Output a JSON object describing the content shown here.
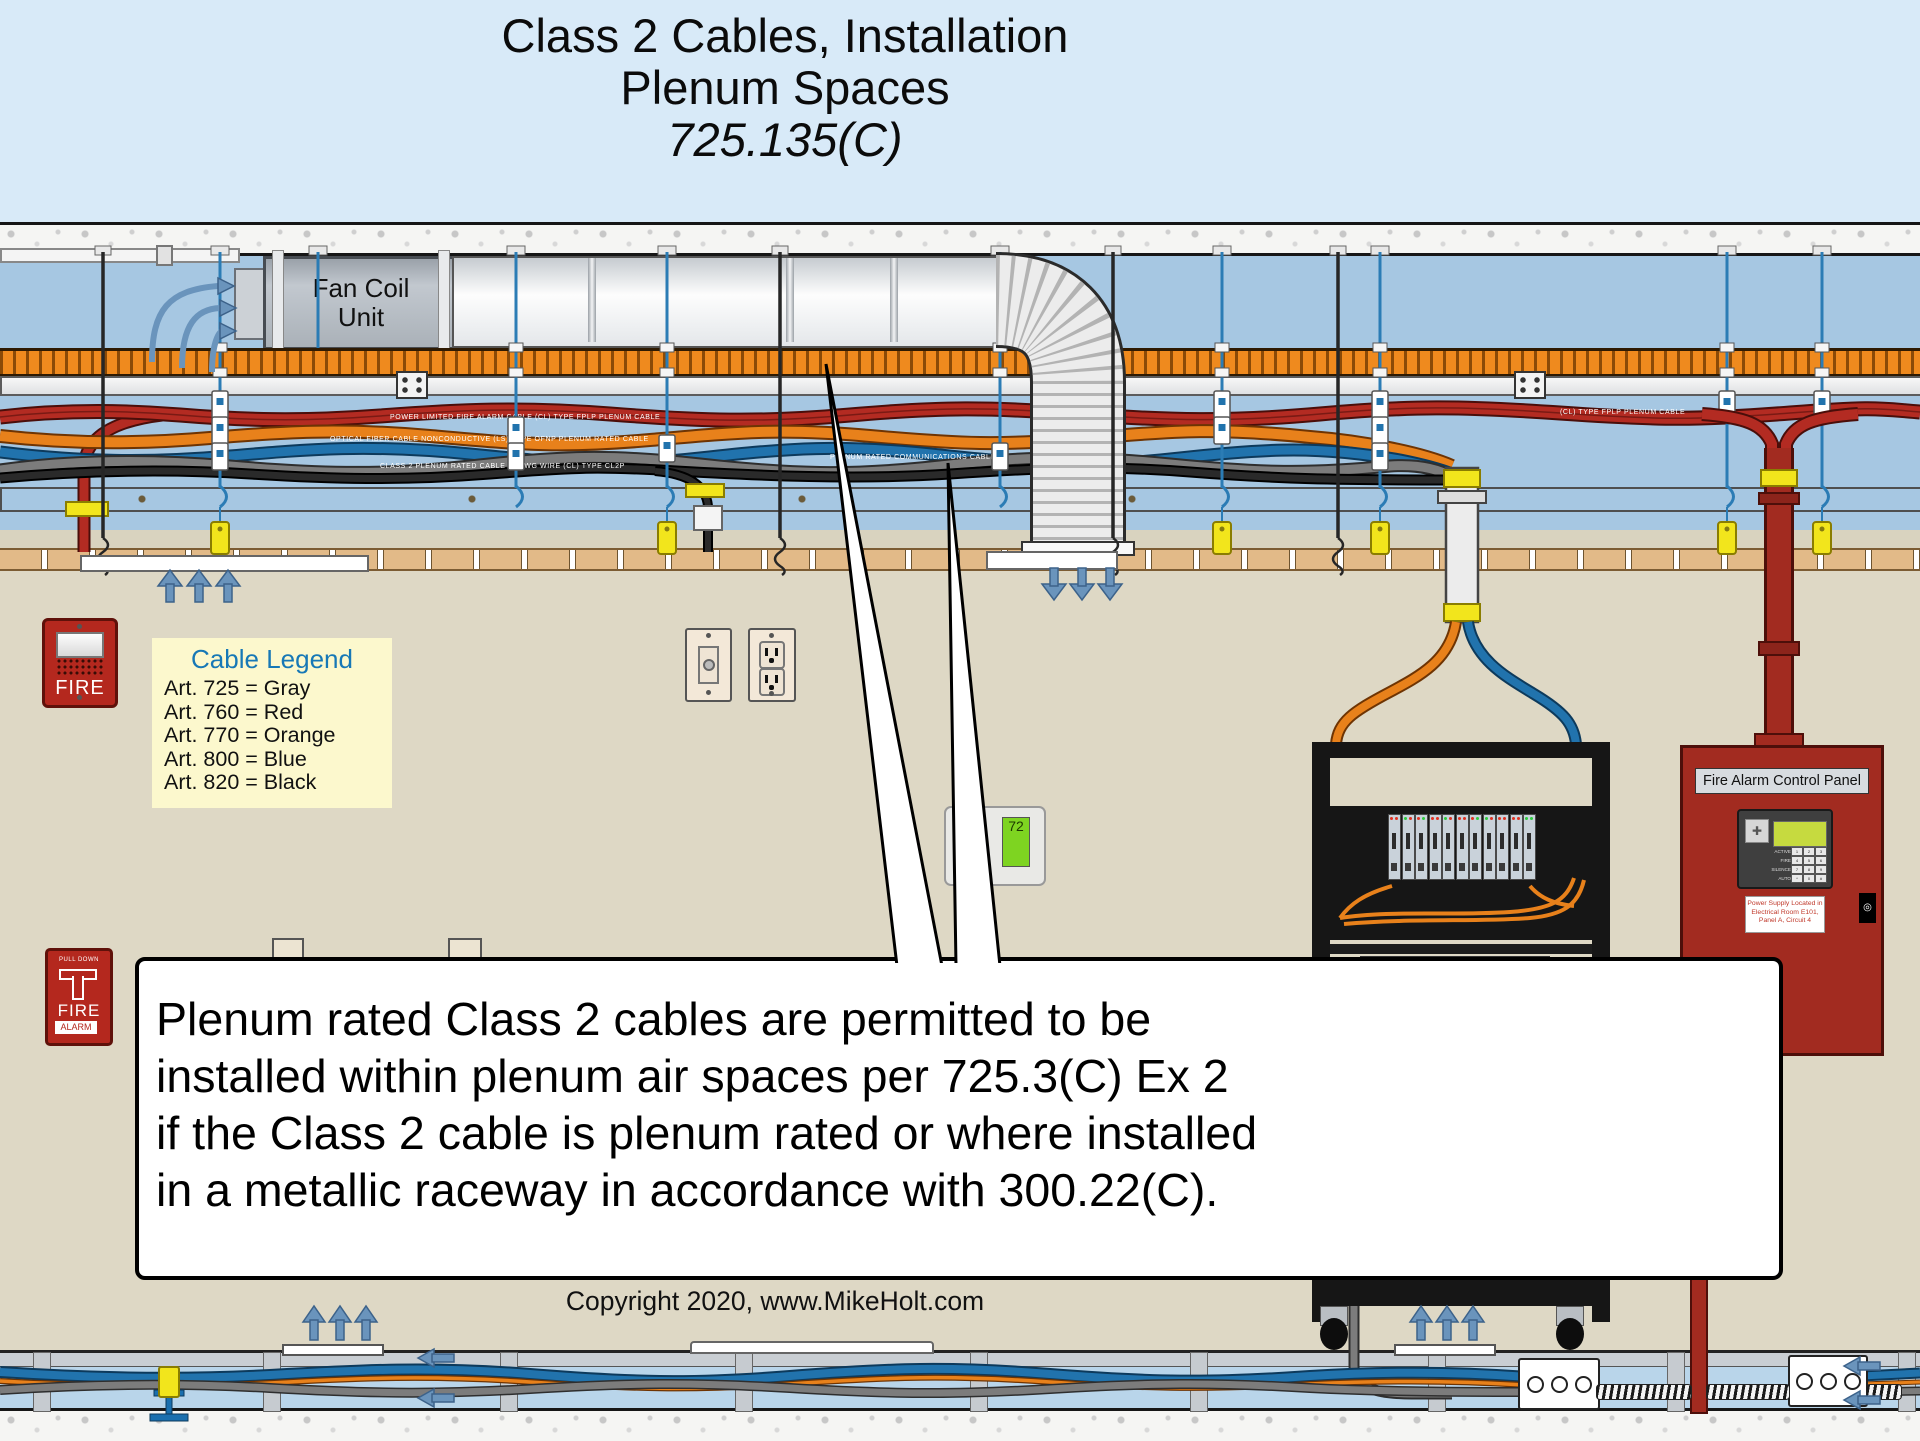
{
  "title": {
    "line1": "Class 2 Cables, Installation",
    "line2": "Plenum Spaces",
    "line3": "725.135(C)"
  },
  "legend": {
    "title": "Cable Legend",
    "items": [
      "Art. 725 = Gray",
      "Art. 760 = Red",
      "Art. 770 = Orange",
      "Art. 800 = Blue",
      "Art. 820 = Black"
    ]
  },
  "callout": {
    "lines": [
      "Plenum rated Class 2 cables are permitted to be",
      "installed within plenum air spaces per 725.3(C) Ex 2",
      "if the Class 2 cable is plenum rated or where installed",
      "in a metallic raceway in accordance with 300.22(C)."
    ]
  },
  "copyright": "Copyright 2020, www.MikeHolt.com",
  "fan_coil": {
    "line1": "Fan Coil",
    "line2": "Unit"
  },
  "fire_horn": {
    "label": "FIRE"
  },
  "pull_station": {
    "top": "PULL DOWN",
    "label": "FIRE",
    "strip": "ALARM"
  },
  "thermostat": {
    "buttons": [
      "ON",
      "OFF",
      "AUTO"
    ],
    "display": "72"
  },
  "facp": {
    "title": "Fire Alarm Control Panel",
    "leds": [
      "ACTIVE",
      "FIRE",
      "SILENCE",
      "AUTO"
    ],
    "keypad": [
      "1",
      "2",
      "3",
      "4",
      "5",
      "6",
      "7",
      "8",
      "9",
      "*",
      "0",
      "#"
    ],
    "label_lines": [
      "Power Supply Located in",
      "Electrical Room E101,",
      "Panel A, Circuit 4"
    ],
    "handle": "O"
  },
  "cable_markings": {
    "red": "POWER LIMITED FIRE ALARM CABLE    (CL)    TYPE FPLP    PLENUM CABLE",
    "red_right": "(CL)    TYPE FPLP    PLENUM CABLE",
    "orange": "OPTICAL FIBER CABLE    NONCONDUCTIVE    (LS)    TYPE OFNP    PLENUM RATED CABLE",
    "gray": "CLASS 2 PLENUM RATED CABLE    18 AWG WIRE    (CL)    TYPE CL2P",
    "blue": "PLENUM RATED COMMUNICATIONS CABLE"
  },
  "colors": {
    "header_blue": "#d8eaf8",
    "plenum_blue": "#a6c7e2",
    "wall_beige": "#ded8c5",
    "legend_bg": "#fcf8cd",
    "legend_title": "#1778b6",
    "cable_red": "#b32b22",
    "cable_orange": "#e8811b",
    "cable_blue": "#2173ad",
    "cable_gray": "#7c7c7c",
    "cable_black": "#2a2a2a",
    "tray_orange": "#ef8a1e",
    "arrow_blue": "#6a94bc",
    "device_red": "#b4281e",
    "tag_yellow": "#f2e51c",
    "grid_tan": "#e2ba88",
    "underfloor_blue": "#b9d5ea"
  }
}
